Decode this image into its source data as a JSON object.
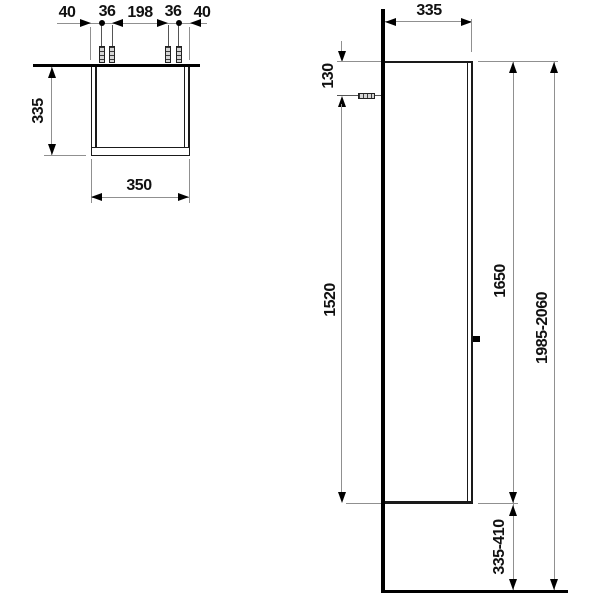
{
  "drawing_title": "tall-cabinet-dimension-drawing",
  "colors": {
    "object_line": "#1a1a1a",
    "heavy_line": "#000000",
    "dimension_line": "#909090",
    "anchor_fill": "#d4d4d4",
    "background": "#ffffff"
  },
  "plan_view": {
    "top_dims": [
      "40",
      "36",
      "198",
      "36",
      "40"
    ],
    "depth_dim": "335",
    "width_dim": "350"
  },
  "elevation_view": {
    "depth_dim": "335",
    "anchor_from_top_dim": "130",
    "anchor_to_bottom_dim": "1520",
    "cabinet_height_dim": "1650",
    "bottom_to_floor_dim": "335-410",
    "total_height_dim": "1985-2060"
  }
}
